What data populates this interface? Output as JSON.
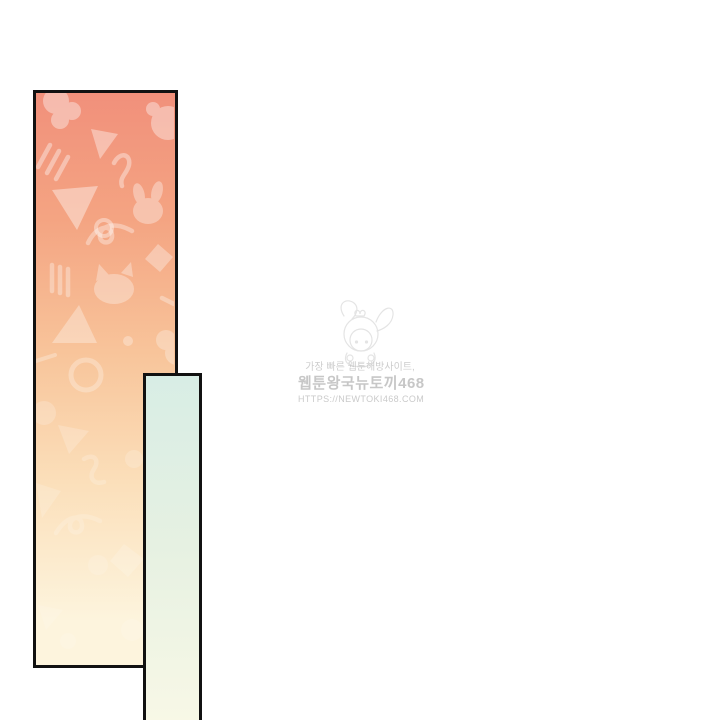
{
  "page": {
    "background_color": "#ffffff"
  },
  "panels": {
    "border_color": "#111111",
    "tall_panel": {
      "gradient": [
        "#f1907b",
        "#f4a482",
        "#f8c59b",
        "#fbdfba",
        "#fdf4dd"
      ],
      "pattern_shapes": [
        "bunny",
        "bear-face",
        "cat-face",
        "triangle",
        "squiggle",
        "ring",
        "diamond",
        "dot",
        "slash-lines"
      ]
    },
    "narrow_panel": {
      "gradient": [
        "#d8ede5",
        "#e6f1e2",
        "#fbf9e7"
      ]
    }
  },
  "watermark": {
    "color": "#c5c5c5",
    "tagline": "가장 빠른 웹툰해방사이트,",
    "site_name": "웹툰왕국뉴토끼468",
    "url": "HTTPS://NEWTOKI468.COM"
  }
}
